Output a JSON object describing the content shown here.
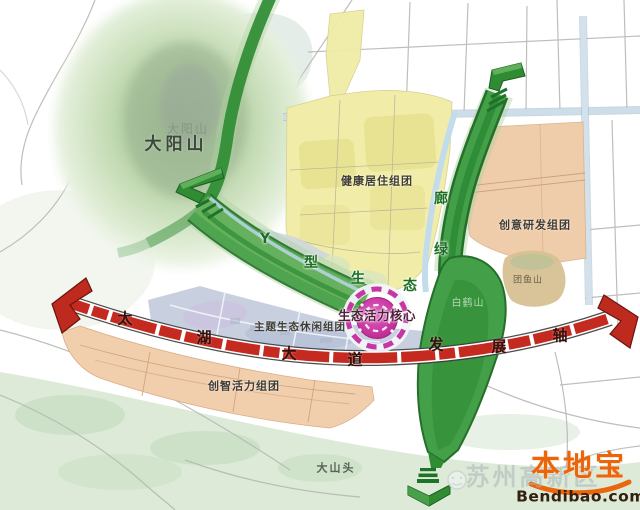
{
  "labels": {
    "dayangshan": "大阳山",
    "dayangshan_ghost": "大阳山",
    "healthy_living": "健康居住组团",
    "creative_rd": "创意研发组团",
    "smart_vitality": "创智活力组团",
    "eco_leisure": "主题生态休闲组团",
    "dashantou": "大山头",
    "tuanyushan": "团鱼山",
    "baiheshan": "白鹤山",
    "core": "生态活力核心"
  },
  "corridor_chars": [
    {
      "char": "Y"
    },
    {
      "char": "型"
    },
    {
      "char": "生"
    },
    {
      "char": "态"
    },
    {
      "char": "绿"
    },
    {
      "char": "廊"
    }
  ],
  "axis_chars": [
    {
      "char": "太"
    },
    {
      "char": "湖"
    },
    {
      "char": "大"
    },
    {
      "char": "道"
    },
    {
      "char": "发"
    },
    {
      "char": "展"
    },
    {
      "char": "轴"
    }
  ],
  "watermark": {
    "text": "苏州高新区"
  },
  "logo": {
    "brand": "本地宝",
    "site": "Bendibao.com"
  },
  "colors": {
    "axis_red": "#c52a20",
    "corridor_green": "#2f8c33",
    "core_magenta": "#c02a96",
    "residential_yellow": "#f1eda8",
    "industry_salmon": "#f0cdaa",
    "logo_orange": "#ea650c"
  }
}
